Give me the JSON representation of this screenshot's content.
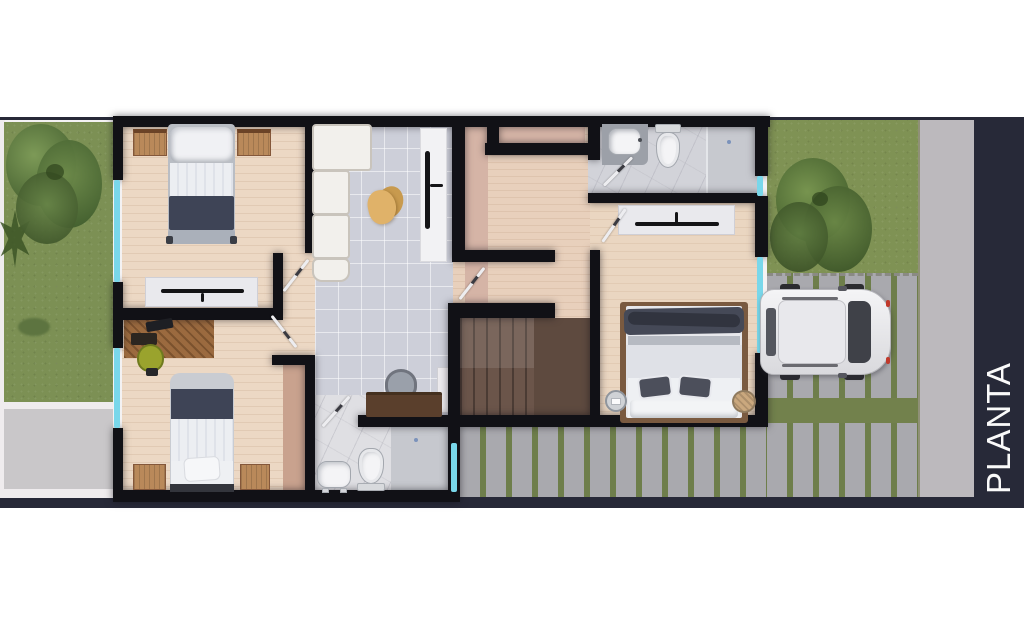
{
  "title": {
    "text": "PLANTA ALTA"
  },
  "palette": {
    "page_background": "#ffffff",
    "panel_navy": "#272938",
    "wall_black": "#111116",
    "window_cyan": "#79d7ea",
    "grass_green": "#7c9054",
    "paver_gray": "#a9a9ae",
    "paver_gap_green": "#6e7e4b",
    "sidewalk_gray": "#bcb9bd",
    "wood_floor": "#ecd8c4",
    "tile_floor": "#cdcfd9",
    "marble_floor": "#dfdfe3",
    "stairs_brown": "#6b554a",
    "blanket_navy": "#3e4456",
    "closet_wood": "#b9895a",
    "title_text": "#fafafa"
  },
  "plan": {
    "label": "PLANTA ALTA",
    "rooms": [
      "bedroom-1",
      "bedroom-2",
      "master-bedroom",
      "bathroom-main",
      "bathroom-secondary",
      "closet",
      "tv-lounge",
      "hallway",
      "stairs"
    ],
    "exterior": [
      "left-garden",
      "patio",
      "right-garden",
      "driveway",
      "sidewalk",
      "parked-car"
    ]
  }
}
